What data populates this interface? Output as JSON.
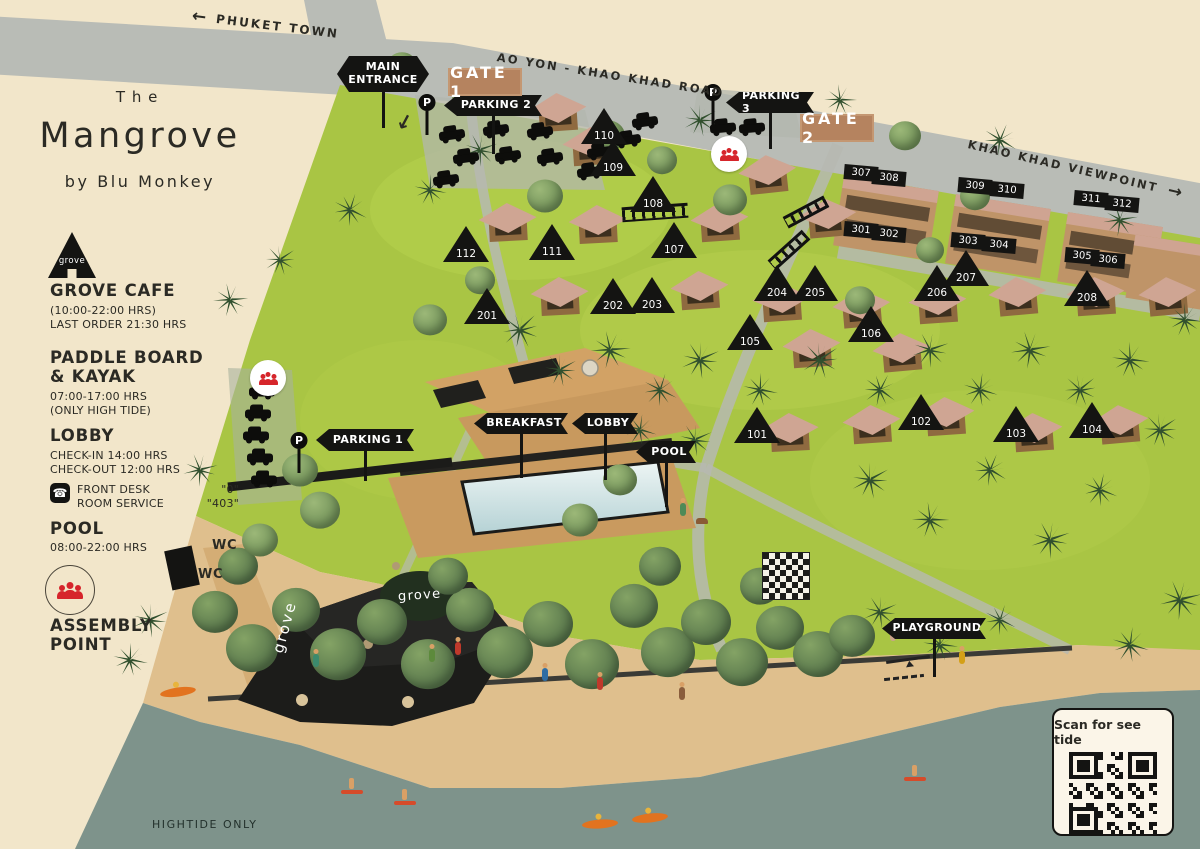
{
  "title": {
    "line1": "The",
    "line2": "Mangrove",
    "line3": "by Blu Monkey"
  },
  "legend": {
    "grove_cafe": {
      "icon_label": "grove",
      "heading": "GROVE CAFE",
      "hours": "(10:00-22:00 HRS)",
      "last_order": "LAST ORDER 21:30 HRS"
    },
    "paddle": {
      "heading1": "PADDLE BOARD",
      "heading2": "& KAYAK",
      "hours": "07:00-17:00 HRS",
      "note": "(ONLY HIGH TIDE)"
    },
    "lobby": {
      "heading": "LOBBY",
      "checkin": "CHECK-IN 14:00 HRS",
      "checkout": "CHECK-OUT 12:00 HRS",
      "front_desk_label": "FRONT DESK",
      "front_desk_value": "\"0\"",
      "room_service_label": "ROOM SERVICE",
      "room_service_value": "\"403\""
    },
    "pool": {
      "heading": "POOL",
      "hours": "08:00-22:00 HRS"
    },
    "assembly": {
      "heading1": "ASSEMBLY",
      "heading2": "POINT"
    }
  },
  "roads": {
    "phuket_town": "PHUKET TOWN",
    "ao_yon": "AO YON - KHAO KHAD ROAD",
    "viewpoint": "KHAO KHAD VIEWPOINT",
    "arrow_left": "←",
    "arrow_right": "→"
  },
  "gates": {
    "gate1": "GATE 1",
    "gate2": "GATE 2"
  },
  "map_labels": {
    "wc1": "WC",
    "wc2": "WC",
    "grove_roof": "grove",
    "grove_sign": "grove",
    "hightide": "HIGHTIDE ONLY",
    "qr_caption": "Scan for see tide",
    "p_sign": "P"
  },
  "flags": [
    {
      "id": "main-entrance",
      "lines": [
        "MAIN",
        "ENTRANCE"
      ],
      "x": 337,
      "y": 56,
      "w": 92,
      "h": 36,
      "pole": 36,
      "both": 1
    },
    {
      "id": "parking-2",
      "lines": [
        "PARKING 2"
      ],
      "x": 444,
      "y": 95,
      "w": 98,
      "h": 21,
      "pole": 38
    },
    {
      "id": "parking-3",
      "lines": [
        "PARKING 3"
      ],
      "x": 726,
      "y": 92,
      "w": 88,
      "h": 21,
      "pole": 36
    },
    {
      "id": "parking-1",
      "lines": [
        "PARKING 1"
      ],
      "x": 316,
      "y": 429,
      "w": 98,
      "h": 22,
      "pole": 30
    },
    {
      "id": "breakfast",
      "lines": [
        "BREAKFAST"
      ],
      "x": 474,
      "y": 413,
      "w": 94,
      "h": 21,
      "pole": 44
    },
    {
      "id": "lobby",
      "lines": [
        "LOBBY"
      ],
      "x": 572,
      "y": 413,
      "w": 66,
      "h": 21,
      "pole": 46
    },
    {
      "id": "pool",
      "lines": [
        "POOL"
      ],
      "x": 636,
      "y": 441,
      "w": 60,
      "h": 22,
      "pole": 44
    },
    {
      "id": "playground",
      "lines": [
        "PLAYGROUND"
      ],
      "x": 882,
      "y": 618,
      "w": 104,
      "h": 21,
      "pole": 38
    }
  ],
  "unit_markers": [
    {
      "label": "110",
      "x": 604,
      "y": 126
    },
    {
      "label": "109",
      "x": 613,
      "y": 158
    },
    {
      "label": "108",
      "x": 653,
      "y": 194
    },
    {
      "label": "112",
      "x": 466,
      "y": 244
    },
    {
      "label": "111",
      "x": 552,
      "y": 242
    },
    {
      "label": "107",
      "x": 674,
      "y": 240
    },
    {
      "label": "201",
      "x": 487,
      "y": 306
    },
    {
      "label": "202",
      "x": 613,
      "y": 296
    },
    {
      "label": "203",
      "x": 652,
      "y": 295
    },
    {
      "label": "204",
      "x": 777,
      "y": 283
    },
    {
      "label": "205",
      "x": 815,
      "y": 283
    },
    {
      "label": "206",
      "x": 937,
      "y": 283
    },
    {
      "label": "207",
      "x": 966,
      "y": 268
    },
    {
      "label": "208",
      "x": 1087,
      "y": 288
    },
    {
      "label": "105",
      "x": 750,
      "y": 332
    },
    {
      "label": "106",
      "x": 871,
      "y": 324
    },
    {
      "label": "101",
      "x": 757,
      "y": 425
    },
    {
      "label": "102",
      "x": 921,
      "y": 412
    },
    {
      "label": "103",
      "x": 1016,
      "y": 424
    },
    {
      "label": "104",
      "x": 1092,
      "y": 420
    }
  ],
  "room_plates": [
    {
      "label": "307",
      "x": 861,
      "y": 173
    },
    {
      "label": "308",
      "x": 889,
      "y": 178
    },
    {
      "label": "309",
      "x": 975,
      "y": 186
    },
    {
      "label": "310",
      "x": 1007,
      "y": 190
    },
    {
      "label": "311",
      "x": 1091,
      "y": 199
    },
    {
      "label": "312",
      "x": 1122,
      "y": 204
    },
    {
      "label": "301",
      "x": 861,
      "y": 230
    },
    {
      "label": "302",
      "x": 889,
      "y": 234
    },
    {
      "label": "303",
      "x": 968,
      "y": 241
    },
    {
      "label": "304",
      "x": 999,
      "y": 245
    },
    {
      "label": "305",
      "x": 1082,
      "y": 256
    },
    {
      "label": "306",
      "x": 1108,
      "y": 260
    }
  ],
  "p_signs": [
    [
      427,
      94
    ],
    [
      713,
      84
    ],
    [
      299,
      432
    ]
  ],
  "assembly_points": [
    [
      729,
      154
    ],
    [
      268,
      378
    ]
  ],
  "colors": {
    "accent_red": "#d6252b",
    "flag_black": "#141412",
    "gate_badge": "#b5835f",
    "grass": "#a9c544",
    "road": "#b9bcb6",
    "sand": "#dfbf8d",
    "water": "#7e938b",
    "background": "#f2e6ca"
  },
  "decor": {
    "trees": [
      [
        215,
        612,
        46,
        0
      ],
      [
        252,
        648,
        52,
        0
      ],
      [
        296,
        610,
        48,
        0
      ],
      [
        338,
        654,
        56,
        0
      ],
      [
        382,
        622,
        50,
        0
      ],
      [
        428,
        664,
        54,
        0
      ],
      [
        470,
        610,
        48,
        0
      ],
      [
        505,
        652,
        56,
        0
      ],
      [
        548,
        624,
        50,
        0
      ],
      [
        592,
        664,
        54,
        0
      ],
      [
        634,
        606,
        48,
        0
      ],
      [
        668,
        652,
        54,
        0
      ],
      [
        706,
        622,
        50,
        0
      ],
      [
        742,
        662,
        52,
        0
      ],
      [
        780,
        628,
        48,
        0
      ],
      [
        818,
        654,
        50,
        0
      ],
      [
        852,
        636,
        46,
        0
      ],
      [
        238,
        566,
        40,
        0
      ],
      [
        448,
        576,
        40,
        0
      ],
      [
        660,
        566,
        42,
        0
      ],
      [
        760,
        586,
        40,
        0
      ],
      [
        470,
        96,
        36,
        1
      ],
      [
        608,
        136,
        34,
        1
      ],
      [
        545,
        196,
        36,
        1
      ],
      [
        662,
        160,
        30,
        1
      ],
      [
        730,
        200,
        34,
        1
      ],
      [
        905,
        136,
        32,
        1
      ],
      [
        975,
        196,
        30,
        1
      ],
      [
        480,
        280,
        30,
        1
      ],
      [
        430,
        320,
        34,
        1
      ],
      [
        300,
        470,
        36,
        1
      ],
      [
        320,
        510,
        40,
        1
      ],
      [
        260,
        540,
        36,
        1
      ],
      [
        620,
        480,
        34,
        1
      ],
      [
        580,
        520,
        36,
        1
      ],
      [
        860,
        300,
        30,
        1
      ],
      [
        930,
        250,
        28,
        1
      ],
      [
        402,
        66,
        30,
        1
      ]
    ],
    "palms": [
      [
        520,
        330,
        34,
        0
      ],
      [
        560,
        370,
        30,
        15
      ],
      [
        610,
        350,
        34,
        40
      ],
      [
        660,
        390,
        30,
        70
      ],
      [
        700,
        360,
        34,
        20
      ],
      [
        760,
        390,
        30,
        55
      ],
      [
        820,
        360,
        34,
        10
      ],
      [
        880,
        390,
        30,
        80
      ],
      [
        930,
        350,
        32,
        25
      ],
      [
        980,
        390,
        30,
        60
      ],
      [
        1030,
        350,
        34,
        35
      ],
      [
        1080,
        390,
        30,
        5
      ],
      [
        1130,
        360,
        32,
        50
      ],
      [
        870,
        480,
        34,
        15
      ],
      [
        930,
        520,
        32,
        45
      ],
      [
        990,
        470,
        30,
        75
      ],
      [
        1050,
        540,
        34,
        25
      ],
      [
        1100,
        490,
        30,
        65
      ],
      [
        1160,
        430,
        32,
        10
      ],
      [
        1180,
        600,
        36,
        30
      ],
      [
        1130,
        645,
        32,
        60
      ],
      [
        880,
        612,
        30,
        20
      ],
      [
        940,
        645,
        30,
        50
      ],
      [
        1000,
        620,
        28,
        70
      ],
      [
        480,
        150,
        30,
        25
      ],
      [
        430,
        190,
        28,
        55
      ],
      [
        700,
        120,
        30,
        15
      ],
      [
        840,
        100,
        28,
        45
      ],
      [
        1000,
        140,
        30,
        75
      ],
      [
        1120,
        220,
        30,
        35
      ],
      [
        695,
        440,
        30,
        20
      ],
      [
        640,
        430,
        28,
        60
      ],
      [
        230,
        300,
        30,
        40
      ],
      [
        280,
        260,
        28,
        10
      ],
      [
        350,
        210,
        30,
        70
      ],
      [
        200,
        470,
        30,
        30
      ],
      [
        1185,
        320,
        30,
        50
      ],
      [
        150,
        620,
        32,
        20
      ],
      [
        130,
        660,
        30,
        55
      ]
    ],
    "villas": [
      [
        558,
        116,
        -4
      ],
      [
        592,
        150,
        -4
      ],
      [
        768,
        178,
        -6
      ],
      [
        508,
        226,
        -3
      ],
      [
        598,
        228,
        -3
      ],
      [
        720,
        226,
        -4
      ],
      [
        828,
        222,
        -5
      ],
      [
        560,
        300,
        -3
      ],
      [
        700,
        294,
        -4
      ],
      [
        782,
        306,
        -4
      ],
      [
        862,
        312,
        -5
      ],
      [
        938,
        308,
        -4
      ],
      [
        1018,
        300,
        -5
      ],
      [
        1096,
        300,
        -4
      ],
      [
        812,
        352,
        -4
      ],
      [
        902,
        356,
        -5
      ],
      [
        790,
        436,
        -3
      ],
      [
        872,
        428,
        -4
      ],
      [
        946,
        420,
        -4
      ],
      [
        1034,
        436,
        -4
      ],
      [
        1120,
        428,
        -5
      ],
      [
        1168,
        300,
        -5
      ]
    ],
    "cars": [
      [
        452,
        135,
        -8
      ],
      [
        496,
        130,
        -8
      ],
      [
        540,
        132,
        -8
      ],
      [
        466,
        158,
        -8
      ],
      [
        508,
        156,
        -8
      ],
      [
        550,
        158,
        -8
      ],
      [
        446,
        180,
        -8
      ],
      [
        600,
        152,
        -8
      ],
      [
        645,
        122,
        -8
      ],
      [
        628,
        140,
        -8
      ],
      [
        590,
        172,
        -8
      ],
      [
        723,
        128,
        -5
      ],
      [
        752,
        128,
        -5
      ],
      [
        262,
        392,
        0
      ],
      [
        258,
        414,
        0
      ],
      [
        256,
        436,
        0
      ],
      [
        260,
        458,
        0
      ],
      [
        264,
        480,
        0
      ]
    ],
    "people": [
      [
        432,
        662,
        "#5d8a3c"
      ],
      [
        458,
        655,
        "#c0392b"
      ],
      [
        545,
        681,
        "#2e6da4"
      ],
      [
        600,
        690,
        "#c0392b"
      ],
      [
        682,
        700,
        "#8a5d3c"
      ],
      [
        893,
        641,
        "#caa28a"
      ],
      [
        962,
        664,
        "#d4a017"
      ],
      [
        316,
        667,
        "#3c8a6d"
      ],
      [
        683,
        516,
        "#4e8a57"
      ]
    ],
    "surfers": [
      [
        352,
        790
      ],
      [
        405,
        801
      ],
      [
        915,
        777
      ]
    ],
    "kayaks": [
      [
        600,
        824,
        -4
      ],
      [
        650,
        818,
        -6
      ],
      [
        178,
        692,
        -8
      ]
    ],
    "ladders": [
      [
        806,
        212,
        62
      ],
      [
        789,
        250,
        48
      ]
    ]
  }
}
